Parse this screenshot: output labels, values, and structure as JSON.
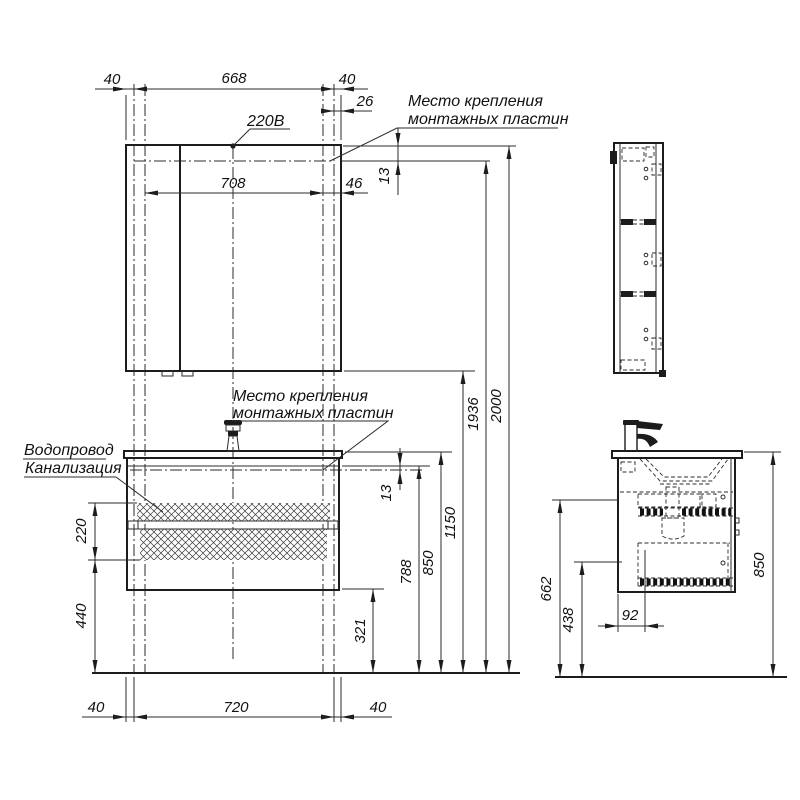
{
  "drawing": {
    "power_label": "220В",
    "mount_label_top": {
      "line1": "Место крепления",
      "line2": "монтажных пластин"
    },
    "mount_label_front": {
      "line1": "Место крепления",
      "line2": "монтажных пластин"
    },
    "plumbing_label": {
      "line1": "Водопровод",
      "line2": "Канализация"
    },
    "mirror_dims": {
      "left_offset": "40",
      "mount_span": "668",
      "right_offset": "40",
      "plate_offset": "26",
      "inner_span": "708",
      "edge_offset": "46",
      "top_offset": "13"
    },
    "height_dims": {
      "total": "2000",
      "mount_top": "1936",
      "mirror_bottom": "1150",
      "countertop": "850",
      "cabinet_top": "788",
      "cabinet_bottom": "321",
      "vanity_mount_offset": "13"
    },
    "zone_dims": {
      "height": "220",
      "floor_offset": "440"
    },
    "bottom_dims": {
      "left_offset": "40",
      "span": "720",
      "right_offset": "40"
    },
    "side_dims": {
      "rail_upper": "662",
      "rail_lower": "438",
      "drain_offset": "92",
      "height": "850"
    }
  }
}
